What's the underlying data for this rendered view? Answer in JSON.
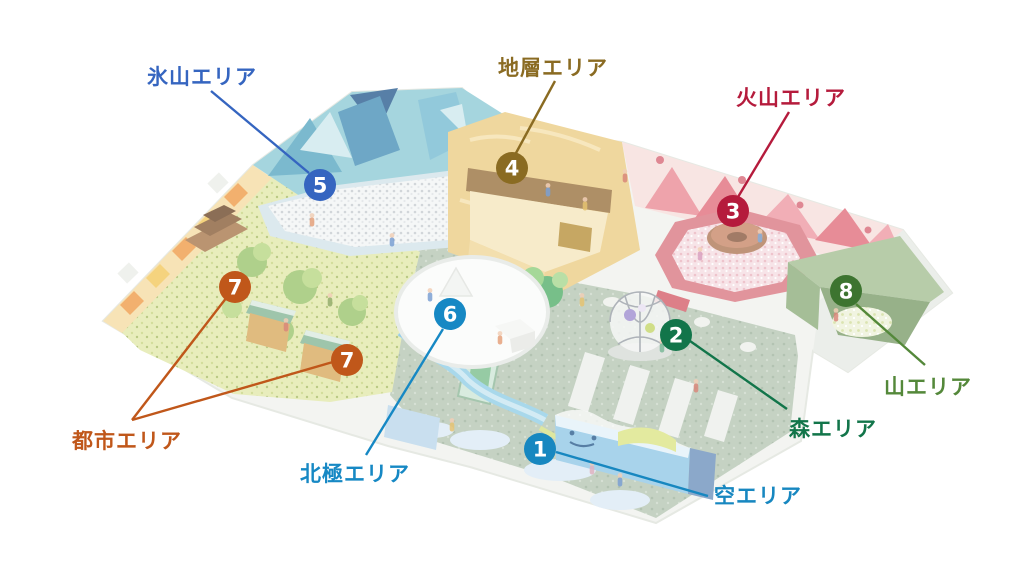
{
  "page": {
    "type": "facility-floor-map",
    "background": "#ffffff",
    "description_icons": [
      "isometric-playground-illustration"
    ]
  },
  "map": {
    "marker_radius": 16,
    "line_width": 2.4,
    "label_font_size": 21,
    "areas": [
      {
        "number": "1",
        "name": "空エリア",
        "color": "#1787c0",
        "label": {
          "x": 714,
          "y": 503,
          "anchor": "start"
        },
        "markers": [
          {
            "x": 540,
            "y": 449
          }
        ],
        "lines": [
          [
            556,
            452,
            708,
            496
          ]
        ]
      },
      {
        "number": "2",
        "name": "森エリア",
        "color": "#12754a",
        "label": {
          "x": 789,
          "y": 436,
          "anchor": "start"
        },
        "markers": [
          {
            "x": 676,
            "y": 335
          }
        ],
        "lines": [
          [
            690,
            341,
            787,
            409
          ]
        ]
      },
      {
        "number": "3",
        "name": "火山エリア",
        "color": "#b51b3c",
        "label": {
          "x": 791,
          "y": 105,
          "anchor": "middle"
        },
        "markers": [
          {
            "x": 733,
            "y": 211
          }
        ],
        "lines": [
          [
            789,
            112,
            738,
            197
          ]
        ]
      },
      {
        "number": "4",
        "name": "地層エリア",
        "color": "#8a6b22",
        "label": {
          "x": 553,
          "y": 75,
          "anchor": "middle"
        },
        "markers": [
          {
            "x": 512,
            "y": 168
          }
        ],
        "lines": [
          [
            555,
            81,
            516,
            153
          ]
        ]
      },
      {
        "number": "5",
        "name": "氷山エリア",
        "color": "#3565c0",
        "label": {
          "x": 202,
          "y": 84,
          "anchor": "middle"
        },
        "markers": [
          {
            "x": 320,
            "y": 185
          }
        ],
        "lines": [
          [
            211,
            91,
            309,
            173
          ]
        ]
      },
      {
        "number": "6",
        "name": "北極エリア",
        "color": "#1688c4",
        "label": {
          "x": 355,
          "y": 481,
          "anchor": "middle"
        },
        "markers": [
          {
            "x": 450,
            "y": 314
          }
        ],
        "lines": [
          [
            443,
            329,
            366,
            455
          ]
        ]
      },
      {
        "number": "7",
        "name": "都市エリア",
        "color": "#c0571a",
        "label": {
          "x": 127,
          "y": 448,
          "anchor": "middle"
        },
        "markers": [
          {
            "x": 235,
            "y": 287
          },
          {
            "x": 347,
            "y": 360
          }
        ],
        "lines": [
          [
            132,
            420,
            227,
            297
          ],
          [
            132,
            420,
            333,
            362
          ]
        ]
      },
      {
        "number": "8",
        "name": "山エリア",
        "color": "#54883a",
        "marker_color": "#3d7430",
        "label": {
          "x": 928,
          "y": 394,
          "anchor": "middle"
        },
        "markers": [
          {
            "x": 846,
            "y": 291
          }
        ],
        "lines": [
          [
            856,
            304,
            925,
            365
          ]
        ]
      }
    ]
  }
}
